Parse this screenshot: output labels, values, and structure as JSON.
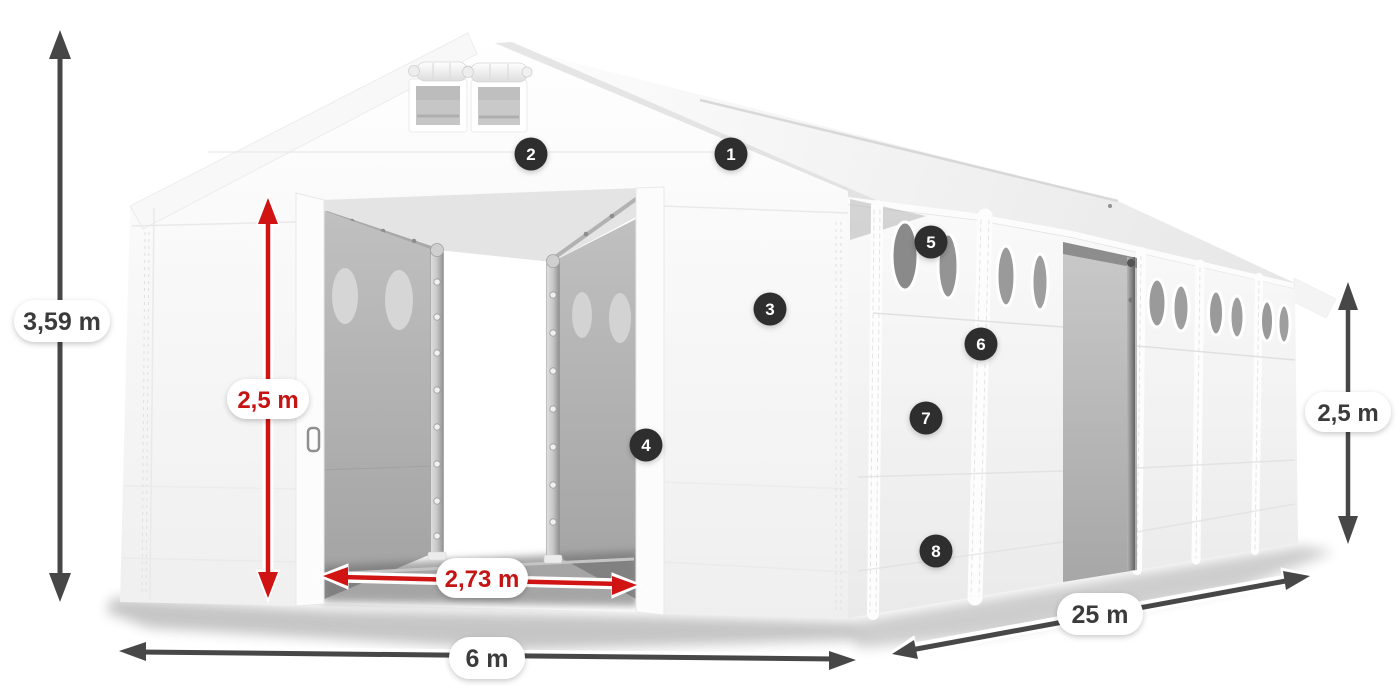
{
  "figure": {
    "title": "storage-tent-dimensions-diagram",
    "dimensions": {
      "total_height": "3,59 m",
      "inner_height": "2,5 m",
      "entrance_width": "2,73 m",
      "width": "6 m",
      "length": "25 m",
      "side_height": "2,5 m"
    },
    "callouts": [
      "1",
      "2",
      "3",
      "4",
      "5",
      "6",
      "7",
      "8"
    ],
    "colors": {
      "dimension_primary": "#474747",
      "dimension_primary_text": "#3b3b3b",
      "dimension_accent": "#d01414",
      "dimension_accent_text": "#c51414",
      "badge_background": "#2d2d2d",
      "badge_number": "#ffffff",
      "tent_white": "#f7f7f7",
      "interior_gray": "#ababab"
    }
  }
}
